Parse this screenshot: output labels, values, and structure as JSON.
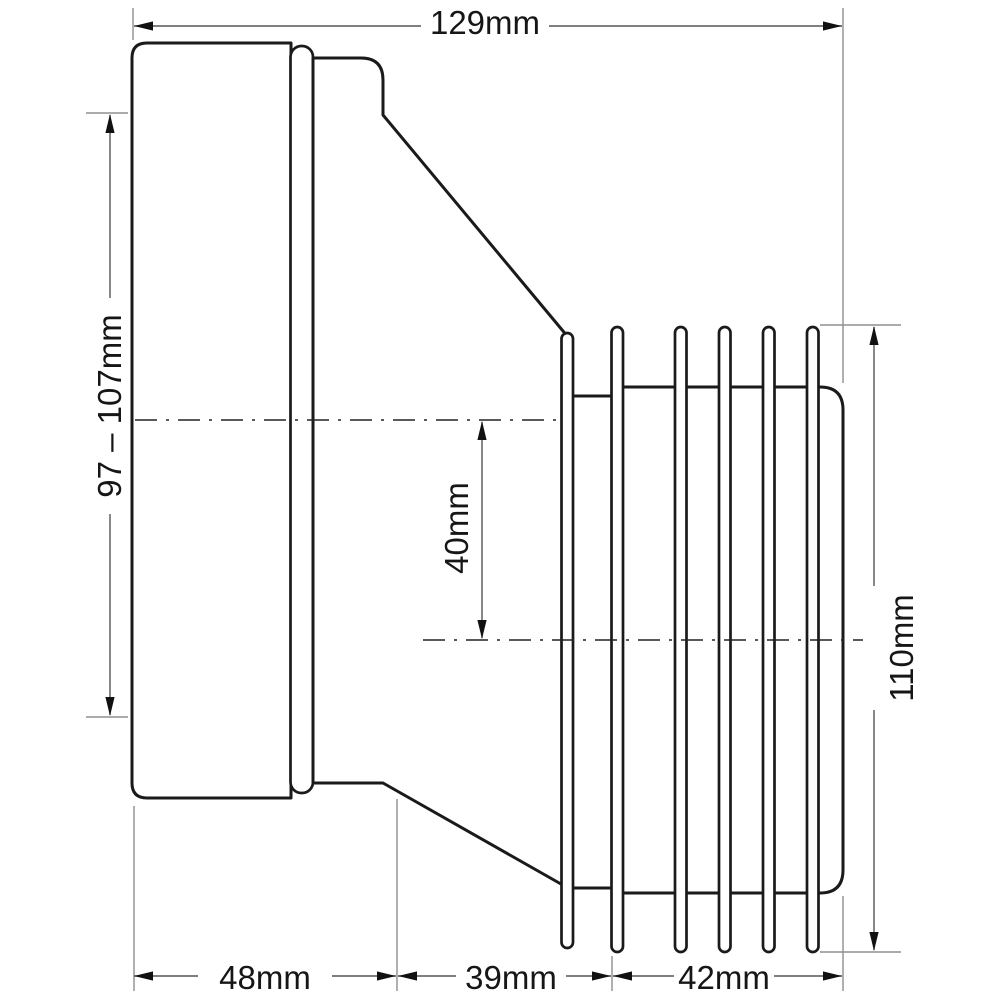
{
  "drawing": {
    "labels": {
      "overall_length": "129mm",
      "inlet_range": "97 – 107mm",
      "offset": "40mm",
      "outlet_diameter": "110mm",
      "seg_socket": "48mm",
      "seg_taper": "39mm",
      "seg_spigot": "42mm"
    },
    "colors": {
      "outline": "#1a1a1a",
      "dimension_line": "#555555",
      "extension_line": "#8f8f8f",
      "arrow": "#111111",
      "text": "#161616",
      "background": "#ffffff"
    }
  }
}
